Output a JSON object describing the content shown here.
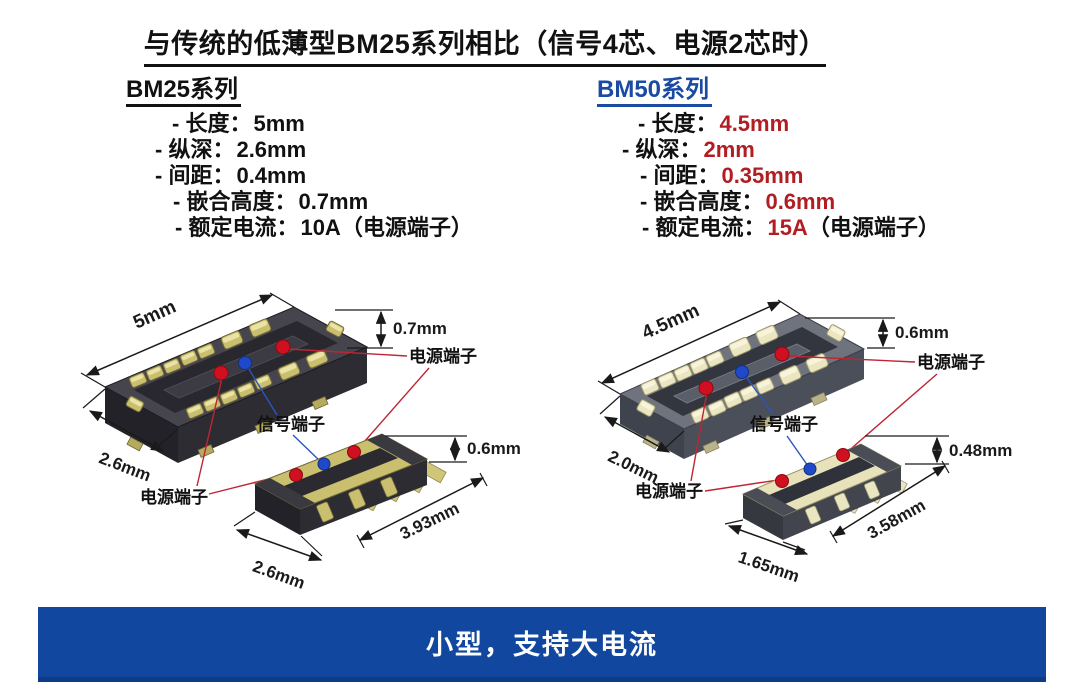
{
  "title": "与传统的低薄型BM25系列相比（信号4芯、电源2芯时）",
  "colors": {
    "heading_blue": "#1b4aa2",
    "value_red": "#b01e23",
    "banner_blue": "#11479e",
    "power_terminal_dot": "#d01020",
    "signal_terminal_dot": "#1f49c8",
    "power_leader_line": "#bf2534",
    "signal_leader_line": "#2a55c0"
  },
  "bm25": {
    "heading": "BM25系列",
    "specs": [
      {
        "label": "- 长度：",
        "value": "5mm",
        "suffix": ""
      },
      {
        "label": "- 纵深：",
        "value": "2.6mm",
        "suffix": ""
      },
      {
        "label": "- 间距：",
        "value": "0.4mm",
        "suffix": ""
      },
      {
        "label": "- 嵌合高度：",
        "value": "0.7mm",
        "suffix": ""
      },
      {
        "label": "- 额定电流：",
        "value": "10A",
        "suffix": "（电源端子）"
      }
    ],
    "figure": {
      "receptacle_length": "5mm",
      "receptacle_depth": "2.6mm",
      "receptacle_height": "0.7mm",
      "plug_height": "0.6mm",
      "plug_length": "3.93mm",
      "plug_depth": "2.6mm",
      "power_terminal_top": "电源端子",
      "signal_terminal": "信号端子",
      "power_terminal_bottom": "电源端子"
    }
  },
  "bm50": {
    "heading": "BM50系列",
    "specs": [
      {
        "label": "- 长度：",
        "value": "4.5mm",
        "suffix": ""
      },
      {
        "label": "- 纵深：",
        "value": "2mm",
        "suffix": ""
      },
      {
        "label": "- 间距：",
        "value": "0.35mm",
        "suffix": ""
      },
      {
        "label": "- 嵌合高度：",
        "value": "0.6mm",
        "suffix": ""
      },
      {
        "label": "- 额定电流：",
        "value": "15A",
        "suffix": "（电源端子）"
      }
    ],
    "figure": {
      "receptacle_length": "4.5mm",
      "receptacle_depth": "2.0mm",
      "receptacle_height": "0.6mm",
      "plug_height": "0.48mm",
      "plug_length": "3.58mm",
      "plug_depth": "1.65mm",
      "power_terminal_top": "电源端子",
      "signal_terminal": "信号端子",
      "power_terminal_bottom": "电源端子"
    }
  },
  "banner": {
    "text": "小型，支持大电流"
  }
}
